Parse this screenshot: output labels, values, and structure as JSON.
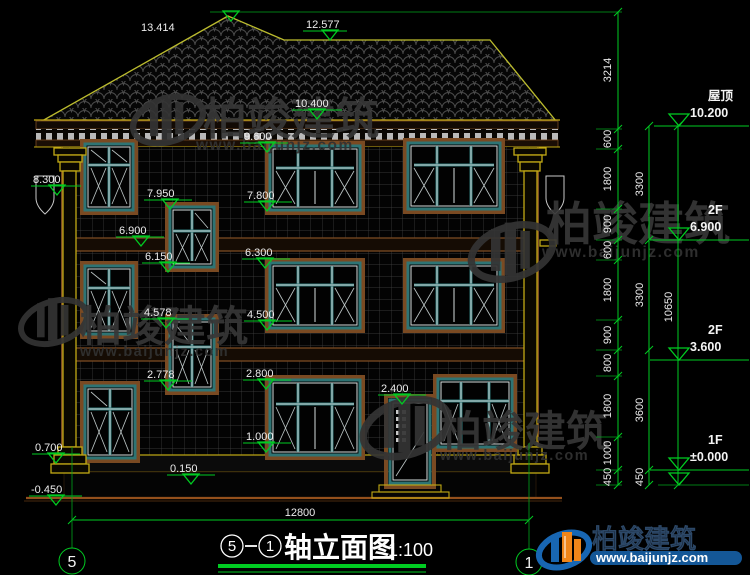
{
  "drawing": {
    "marks": [
      "13.414",
      "12.577",
      "10.400",
      "9.600",
      "8.300",
      "7.950",
      "7.800",
      "6.900",
      "6.300",
      "6.150",
      "4.578",
      "4.500",
      "2.778",
      "2.800",
      "2.400",
      "1.000",
      "0.700",
      "0.150",
      "-0.450"
    ],
    "right_dims": {
      "col1": [
        "3214",
        "600",
        "1800",
        "900",
        "600",
        "1800",
        "900",
        "800",
        "1800",
        "1000",
        "450"
      ],
      "col2": [
        "3300",
        "3300",
        "3600",
        "450"
      ],
      "overall": "10650"
    },
    "floors": [
      {
        "name": "屋顶",
        "elev": "10.200"
      },
      {
        "name": "2F",
        "elev": "6.900"
      },
      {
        "name": "2F",
        "elev": "3.600"
      },
      {
        "name": "1F",
        "elev": "±0.000"
      }
    ],
    "bottom_dim": "12800",
    "axes": {
      "left": "5",
      "right": "1"
    },
    "title": {
      "bubble_left": "5",
      "bubble_right": "1",
      "text": "轴立面图",
      "scale": "1:100"
    }
  },
  "watermark": {
    "brand": "柏竣建筑",
    "url": "www.baijunjz.com"
  }
}
